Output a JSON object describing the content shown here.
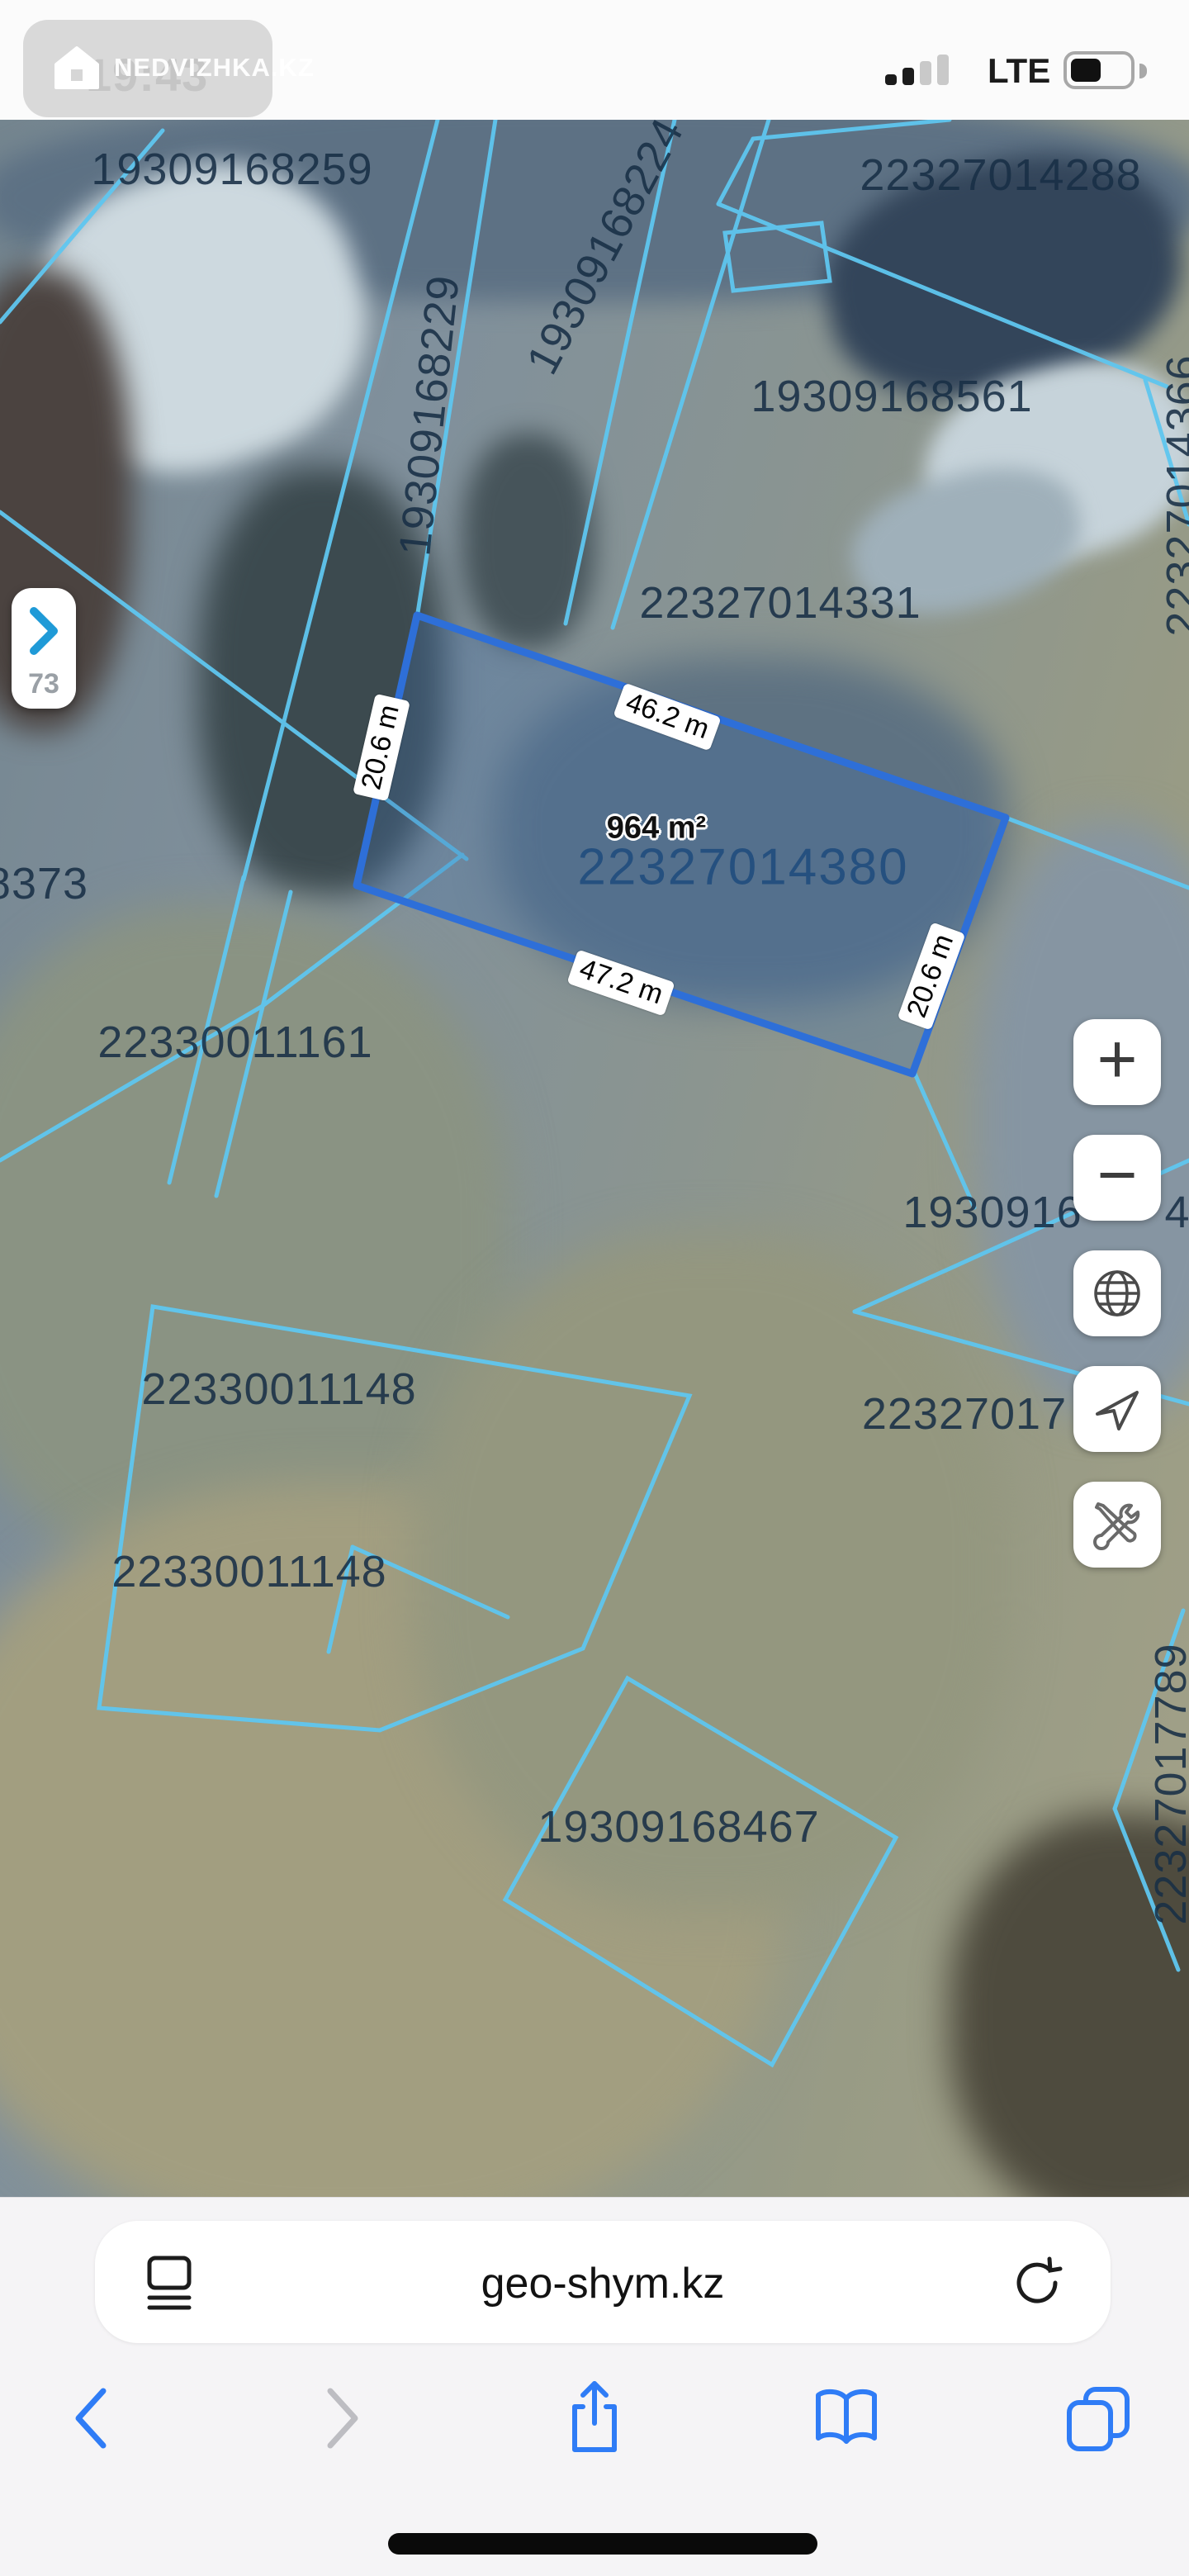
{
  "status_bar": {
    "time": "19:43",
    "network": "LTE",
    "signal_bars": {
      "total": 4,
      "filled": 2
    },
    "battery_fill_ratio": 0.42,
    "watermark_text": "NEDVIZHKA.KZ"
  },
  "map": {
    "labels": {
      "p259": "19309168259",
      "p224": "19309168224",
      "p229": "19309168229",
      "p288": "22327014288",
      "p561": "19309168561",
      "p331": "22327014331",
      "p366": "22327014366",
      "p8373": "8373",
      "p1161": "22330011161",
      "p1148a": "22330011148",
      "p1148b": "22330011148",
      "p467": "19309168467",
      "p17789": "22327017789",
      "frag_1930916": "1930916",
      "frag_4": "4",
      "frag_22327017": "22327017"
    },
    "selected_parcel": {
      "id": "22327014380",
      "area": "964 m²",
      "side_top": "46.2 m",
      "side_left": "20.6 m",
      "side_bottom": "47.2 m",
      "side_right": "20.6 m"
    },
    "panel_toggle": {
      "label": "73"
    },
    "controls": {
      "zoom_in": "+",
      "zoom_out": "−"
    },
    "colors": {
      "parcel_line": "#5fc6ef",
      "selected_stroke": "#2e6fd8",
      "selected_fill": "rgba(62,108,170,0.30)",
      "label_text": "#1d3349",
      "selected_label_text": "#1d4a7d"
    }
  },
  "browser": {
    "url": "geo-shym.kz"
  },
  "icons": {
    "watermark_logo": "house",
    "panel_chevron": "chevron-right",
    "zoom_in": "plus",
    "zoom_out": "minus",
    "layers": "globe",
    "locate": "navigation-arrow",
    "tools": "wrench-screwdriver",
    "reader": "page-with-lines",
    "reload": "refresh-arrow",
    "back": "chevron-left",
    "forward": "chevron-right",
    "share": "share-up-arrow",
    "bookmarks": "open-book",
    "tabs": "stacked-squares",
    "home": "home-indicator-bar"
  }
}
